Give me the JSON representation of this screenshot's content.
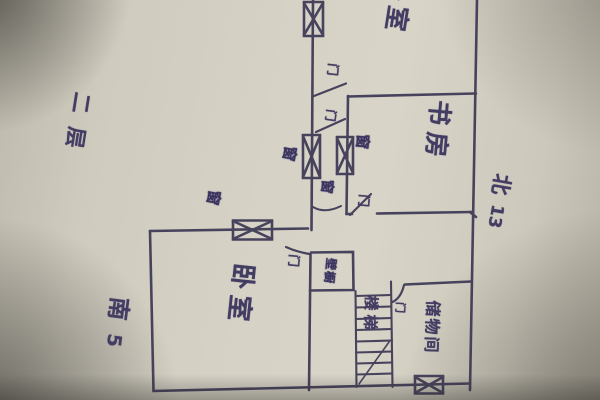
{
  "plan": {
    "floor_note": "二层",
    "orientation": {
      "north_label": "北",
      "north_value": "13",
      "south_label": "南",
      "south_value": "5"
    },
    "rooms": {
      "bedroom_top": "卧室",
      "study": "书房",
      "bedroom_lower": "卧室",
      "stairs": "楼梯",
      "storage": "储物间",
      "closet": "壁橱"
    },
    "annotations": {
      "door": "门",
      "window": "窗"
    }
  },
  "colors": {
    "ink": "#3e3955",
    "scribble_ink": "#3b3460",
    "paper": "#d2cec2"
  }
}
